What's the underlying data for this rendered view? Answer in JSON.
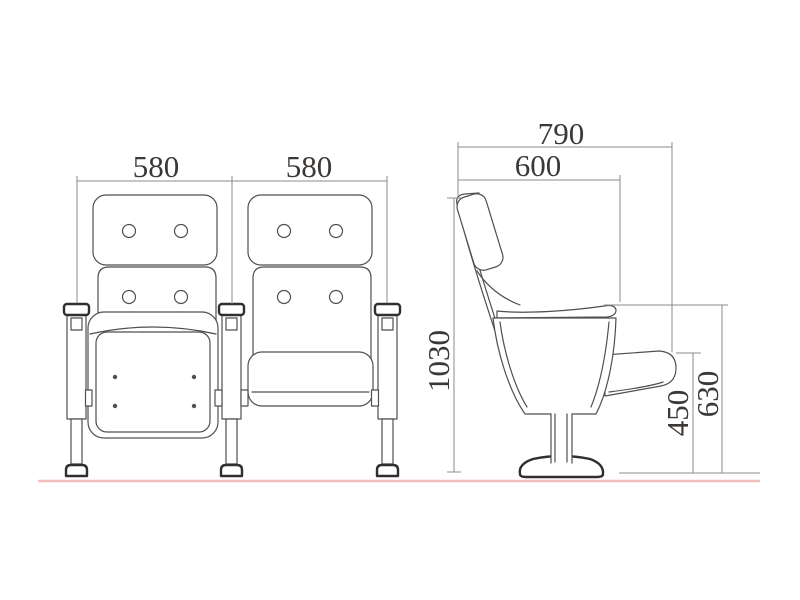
{
  "dimensions": {
    "front": {
      "chair1_width": "580",
      "chair2_width": "580"
    },
    "side": {
      "overall_depth": "790",
      "seat_depth": "600",
      "overall_height": "1030",
      "armrest_height": "450",
      "seat_back_height": "630"
    }
  },
  "colors": {
    "line": "#4f4f4f",
    "bold_line": "#2f2f2f",
    "dim": "#8b8b8b",
    "text": "#3c3835",
    "ground": "#f4bebe",
    "background": "#ffffff"
  }
}
